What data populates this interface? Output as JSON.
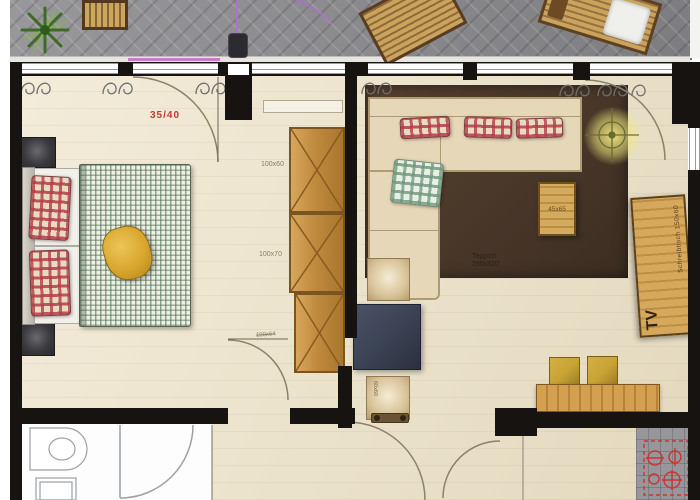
{
  "title": "Apartment floor plan with balcony",
  "labels": {
    "bedroom_door": "35/40",
    "wardrobe_upper": "100x60",
    "wardrobe_mid": "100x70",
    "bedroom_exit_door": "100x64",
    "side_table": "45x65",
    "rug": "Teppich 230x320",
    "desk": "Schreibtisch 150x60",
    "tv": "TV",
    "pouf": "60x60"
  },
  "colors": {
    "wall": "#161310",
    "floor": "#ede2c6",
    "balcony_paving": "#8f8f93",
    "rug": "#4a382a",
    "wardrobe_wood": "#c08a3e",
    "sofa": "#e6d7b8",
    "plaid_red": "#b43c4a",
    "plaid_green": "#6d8a77",
    "duvet_green": "#5f7d5f",
    "pillow_yellow": "#d9a62e",
    "dimension_red": "#c23b32",
    "magenta_accent": "#c66ac6",
    "lamp_glow": "#f0e87e",
    "kitchen_symbol_red": "#cc3333"
  }
}
